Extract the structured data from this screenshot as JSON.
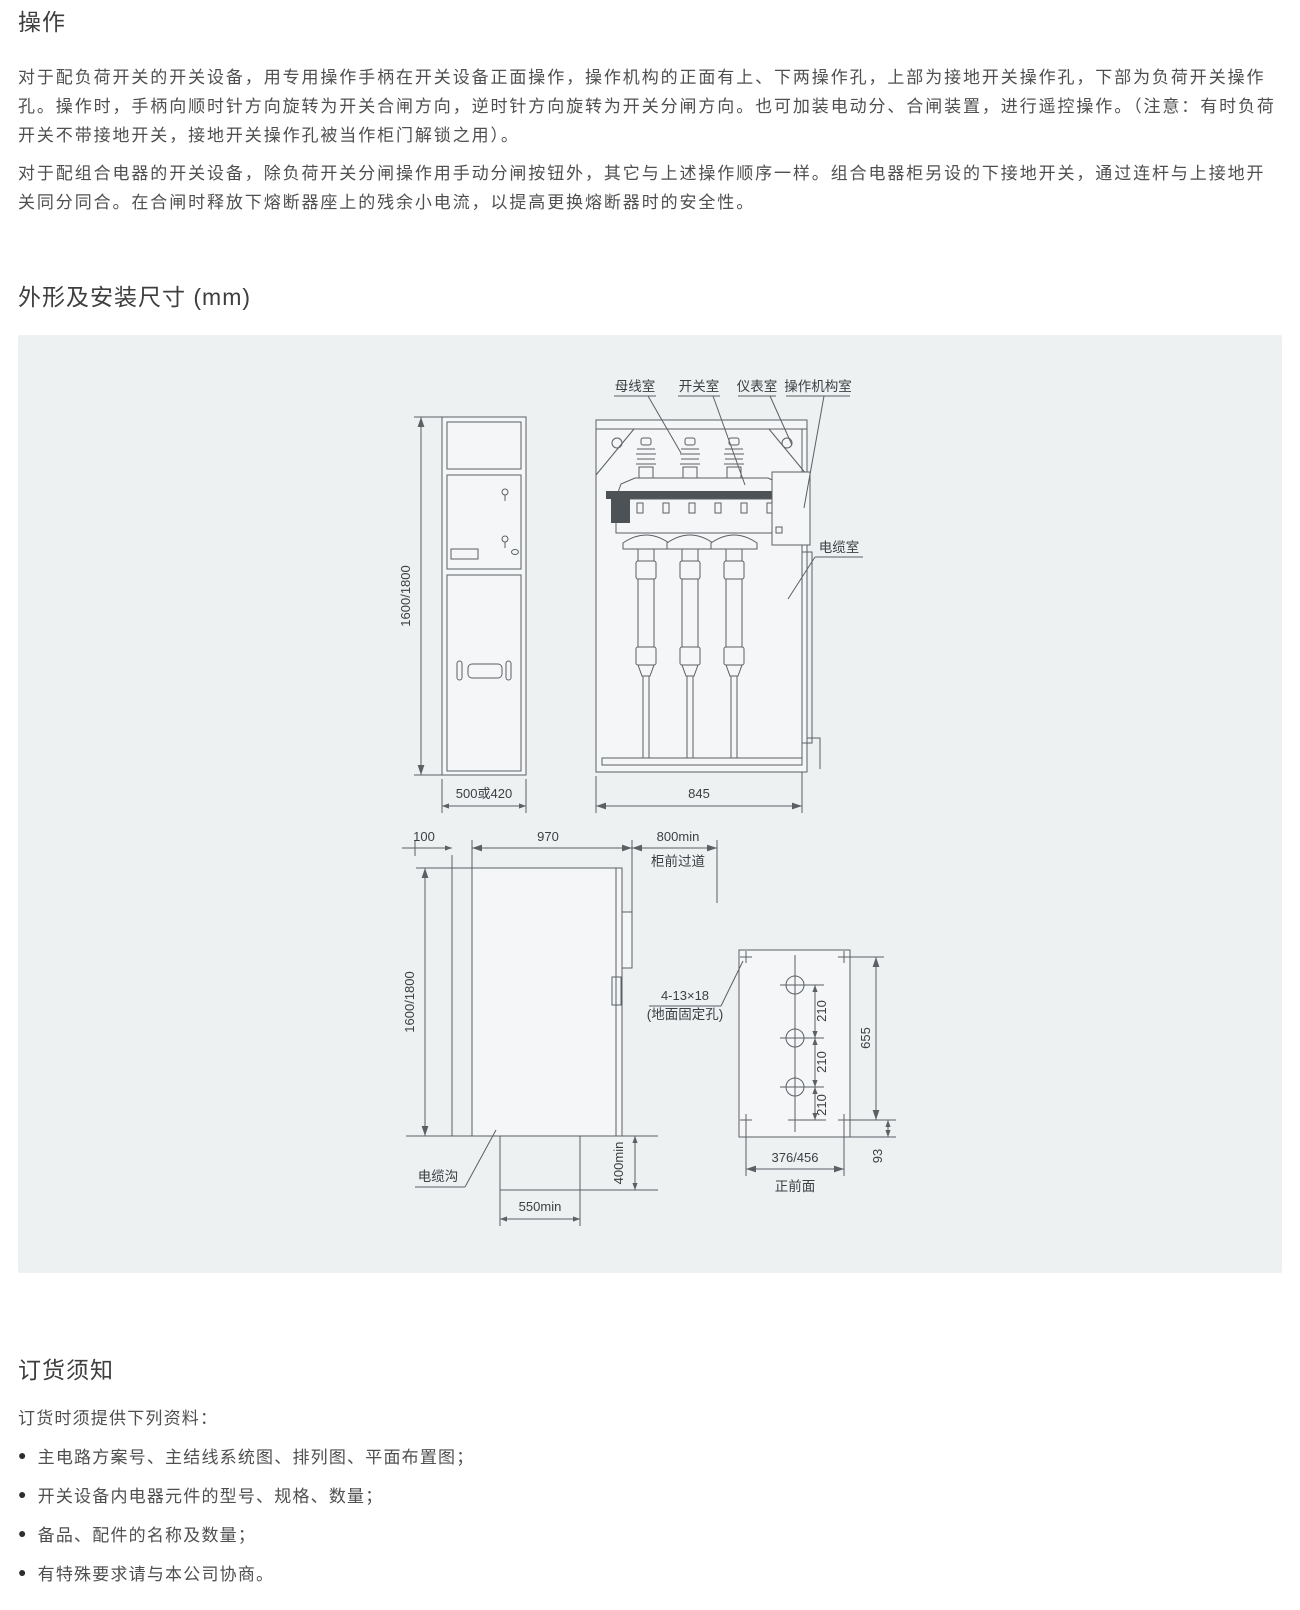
{
  "operation": {
    "title": "操作",
    "para1": "对于配负荷开关的开关设备，用专用操作手柄在开关设备正面操作，操作机构的正面有上、下两操作孔，上部为接地开关操作孔，下部为负荷开关操作孔。操作时，手柄向顺时针方向旋转为开关合闸方向，逆时针方向旋转为开关分闸方向。也可加装电动分、合闸装置，进行遥控操作。（注意：有时负荷开关不带接地开关，接地开关操作孔被当作柜门解锁之用）。",
    "para2": "对于配组合电器的开关设备，除负荷开关分闸操作用手动分闸按钮外，其它与上述操作顺序一样。组合电器柜另设的下接地开关，通过连杆与上接地开关同分同合。在合闸时释放下熔断器座上的残余小电流，以提高更换熔断器时的安全性。"
  },
  "dimensions_section": {
    "title": "外形及安装尺寸 (mm)"
  },
  "diagram": {
    "front_view": {
      "height": "1600/1800",
      "width": "500或420"
    },
    "side_view": {
      "busbar_room": "母线室",
      "switch_room": "开关室",
      "instrument_room": "仪表室",
      "mechanism_room": "操作机构室",
      "cable_room": "电缆室",
      "width": "845"
    },
    "section_view": {
      "d100": "100",
      "d970": "970",
      "d800": "800min",
      "aisle": "柜前过道",
      "height": "1600/1800",
      "trench": "电缆沟",
      "d550": "550min",
      "d400": "400min"
    },
    "plan_view": {
      "holes": "4-13×18",
      "holes_note": "(地面固定孔)",
      "d210a": "210",
      "d210b": "210",
      "d210c": "210",
      "d655": "655",
      "d376": "376/456",
      "d93": "93",
      "front_label": "正前面"
    }
  },
  "ordering": {
    "title": "订货须知",
    "intro": "订货时须提供下列资料：",
    "items": [
      "主电路方案号、主结线系统图、排列图、平面布置图；",
      "开关设备内电器元件的型号、规格、数量；",
      "备品、配件的名称及数量；",
      "有特殊要求请与本公司协商。"
    ]
  },
  "icons": {
    "bullet": "●"
  },
  "colors": {
    "panel_bg": "#eef1f2",
    "line": "#5b6065",
    "heading": "#3e3e3e",
    "body_text": "#4f4f4f"
  }
}
